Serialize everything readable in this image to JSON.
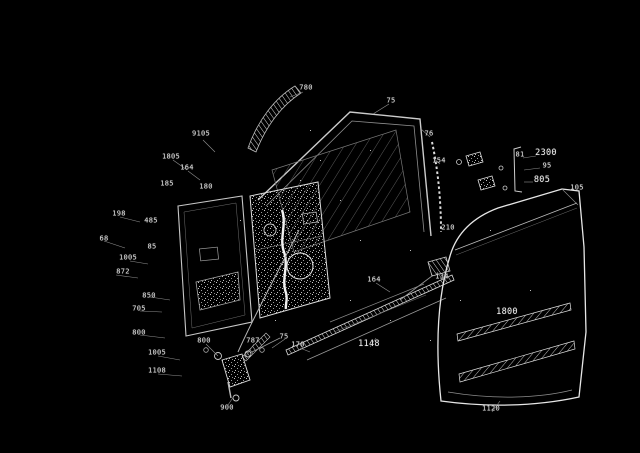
{
  "meta": {
    "type": "exploded-parts-diagram",
    "subject": "front-door-assembly",
    "background_color": "#000000",
    "line_color": "#ffffff",
    "label_color": "#e2e2e2"
  },
  "labels": [
    {
      "text": "780",
      "x": 306,
      "y": 88
    },
    {
      "text": "75",
      "x": 391,
      "y": 101
    },
    {
      "text": "9105",
      "x": 201,
      "y": 134
    },
    {
      "text": "1805",
      "x": 171,
      "y": 157
    },
    {
      "text": "164",
      "x": 187,
      "y": 168
    },
    {
      "text": "185",
      "x": 167,
      "y": 184
    },
    {
      "text": "180",
      "x": 206,
      "y": 187
    },
    {
      "text": "198",
      "x": 119,
      "y": 214
    },
    {
      "text": "485",
      "x": 151,
      "y": 221
    },
    {
      "text": "68",
      "x": 104,
      "y": 239
    },
    {
      "text": "85",
      "x": 152,
      "y": 247
    },
    {
      "text": "1005",
      "x": 128,
      "y": 258
    },
    {
      "text": "872",
      "x": 123,
      "y": 272
    },
    {
      "text": "850",
      "x": 149,
      "y": 296
    },
    {
      "text": "705",
      "x": 139,
      "y": 309
    },
    {
      "text": "800",
      "x": 139,
      "y": 333
    },
    {
      "text": "1005",
      "x": 157,
      "y": 353
    },
    {
      "text": "1108",
      "x": 157,
      "y": 371
    },
    {
      "text": "800",
      "x": 204,
      "y": 341
    },
    {
      "text": "787",
      "x": 253,
      "y": 341
    },
    {
      "text": "75",
      "x": 284,
      "y": 337
    },
    {
      "text": "900",
      "x": 227,
      "y": 408
    },
    {
      "text": "170",
      "x": 298,
      "y": 345
    },
    {
      "text": "1148",
      "x": 369,
      "y": 344,
      "size": 8.5
    },
    {
      "text": "164",
      "x": 374,
      "y": 280
    },
    {
      "text": "134",
      "x": 442,
      "y": 277
    },
    {
      "text": "76",
      "x": 429,
      "y": 134
    },
    {
      "text": "154",
      "x": 439,
      "y": 161
    },
    {
      "text": "210",
      "x": 448,
      "y": 228
    },
    {
      "text": "81",
      "x": 520,
      "y": 155
    },
    {
      "text": "2300",
      "x": 546,
      "y": 153,
      "size": 8.5
    },
    {
      "text": "95",
      "x": 547,
      "y": 166
    },
    {
      "text": "805",
      "x": 542,
      "y": 180,
      "size": 8.5
    },
    {
      "text": "1800",
      "x": 507,
      "y": 312,
      "size": 8.5
    },
    {
      "text": "1120",
      "x": 491,
      "y": 409
    },
    {
      "text": "105",
      "x": 577,
      "y": 188
    }
  ]
}
